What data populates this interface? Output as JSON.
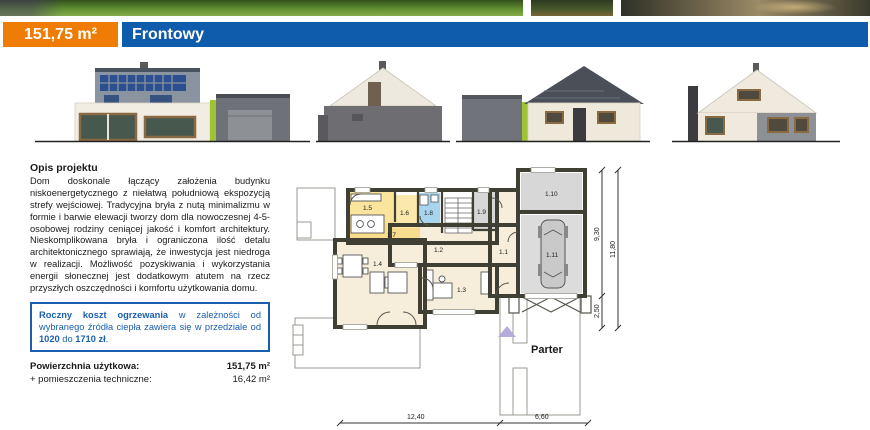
{
  "header": {
    "area": "151,75 m²",
    "title": "Frontowy"
  },
  "description": {
    "heading": "Opis projektu",
    "body": "Dom doskonale łączący założenia budynku niskoenergetycznego z niełatwą południową ekspozycją strefy wejściowej. Tradycyjna bryła z nutą minimalizmu w formie i barwie elewacji tworzy dom dla nowoczesnej 4-5-osobowej rodziny ceniącej jakość i komfort architektury. Nieskomplikowana bryła i ograniczona ilość detalu architektonicznego sprawiają, że inwestycja jest niedroga w realizacji. Możliwość pozyskiwania i wykorzystania energii słonecznej jest dodatkowym atutem na rzecz przyszłych oszczędności i komfortu użytkowania domu."
  },
  "heating": {
    "s1": "Roczny koszt ogrzewania",
    "s2": " w zależności od wybranego źródła ciepła zawiera się w przedziale od ",
    "s3": "1020",
    "s4": " do ",
    "s5": "1710 zł",
    "s6": "."
  },
  "areas": {
    "rows": [
      {
        "label": "Powierzchnia użytkowa:",
        "value": "151,75 m²"
      },
      {
        "label": "+ pomieszczenia techniczne:",
        "value": "16,42 m²"
      }
    ]
  },
  "plan": {
    "floor_label": "Parter",
    "rooms": [
      {
        "label": "1.1"
      },
      {
        "label": "1.2"
      },
      {
        "label": "1.3"
      },
      {
        "label": "1.4"
      },
      {
        "label": "1.5"
      },
      {
        "label": "1.6"
      },
      {
        "label": "1.7"
      },
      {
        "label": "1.8"
      },
      {
        "label": "1.9"
      },
      {
        "label": "1.10"
      },
      {
        "label": "1.11"
      }
    ],
    "dimensions": {
      "main_width": "12,40",
      "garage_width": "6,60",
      "depth_main": "9,30",
      "depth_front": "2,50",
      "depth_total": "11,80"
    }
  },
  "colors": {
    "accent_orange": "#ef7d05",
    "accent_blue": "#0e5cab",
    "heating_box_blue": "#1a5fae",
    "plan_wall": "#3f3f33",
    "room_cream": "#f6eedb",
    "room_yellow": "#fbe49b",
    "room_blue": "#a8d4ee",
    "room_gray": "#d7d7d7",
    "eco_green": "#9fc332"
  }
}
